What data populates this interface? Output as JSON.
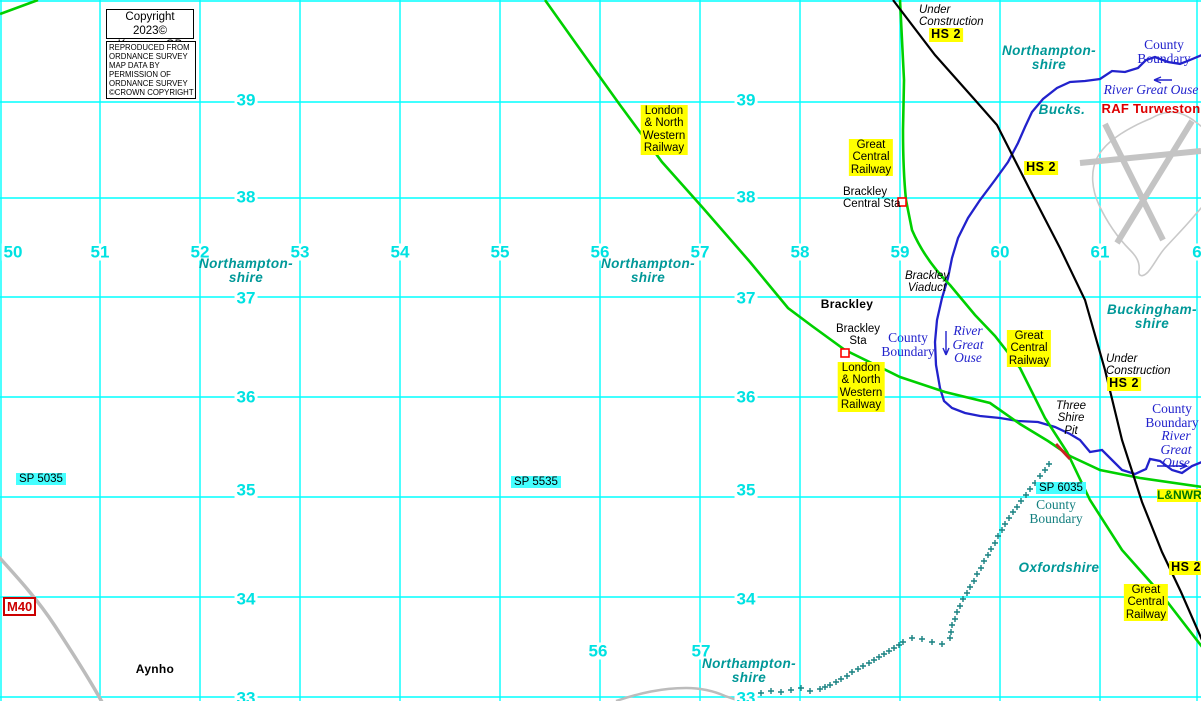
{
  "title": "KeymapsGB map extract - Brackley area",
  "copyright": {
    "line1": "Copyright 2023©",
    "line2": "KeymapsGB",
    "notice": "REPRODUCED FROM\nORDNANCE SURVEY\nMAP DATA BY\nPERMISSION OF\nORDNANCE SURVEY\n©CROWN COPYRIGHT"
  },
  "colors": {
    "grid_cyan": "#00ffff",
    "grid_number_cyan": "#00e2e2",
    "railway_green": "#00d000",
    "hs2_black": "#000000",
    "river_blue": "#2222cc",
    "region_teal": "#009898",
    "boundary_teal": "#137f7f",
    "highlight_yellow": "#ffff00",
    "highlight_cyan": "#45ffff",
    "warning_red": "#dd0000",
    "road_gray": "#c4c4c4"
  },
  "grid": {
    "eastings_y": 252,
    "eastings": [
      {
        "v": "50",
        "x": 13
      },
      {
        "v": "51",
        "x": 100
      },
      {
        "v": "52",
        "x": 200
      },
      {
        "v": "53",
        "x": 300
      },
      {
        "v": "54",
        "x": 400
      },
      {
        "v": "55",
        "x": 500
      },
      {
        "v": "56",
        "x": 600
      },
      {
        "v": "57",
        "x": 700
      },
      {
        "v": "58",
        "x": 800
      },
      {
        "v": "59",
        "x": 900
      },
      {
        "v": "60",
        "x": 1000
      },
      {
        "v": "61",
        "x": 1100
      },
      {
        "v": "6",
        "x": 1197
      }
    ],
    "bottom_eastings_y": 651,
    "bottom_eastings": [
      {
        "v": "56",
        "x": 598
      },
      {
        "v": "57",
        "x": 701
      }
    ],
    "northing_xs": [
      246,
      746
    ],
    "northings": [
      {
        "v": "39",
        "y": 100
      },
      {
        "v": "38",
        "y": 197
      },
      {
        "v": "37",
        "y": 298
      },
      {
        "v": "36",
        "y": 397
      },
      {
        "v": "35",
        "y": 490
      },
      {
        "v": "34",
        "y": 599
      },
      {
        "v": "33",
        "y": 698
      }
    ]
  },
  "labels_static": {
    "m40": "M40"
  },
  "labels": [
    {
      "name": "under-construction-label-top",
      "text": "Under\nConstruction",
      "x": 919,
      "y": 4,
      "cls": "ital left sm"
    },
    {
      "name": "hs2-label-top",
      "text": "HS 2",
      "x": 946,
      "y": 28,
      "cls": "yellow hs2"
    },
    {
      "name": "northamptonshire-label-topright",
      "text": "Northampton-\nshire",
      "x": 1049,
      "y": 44,
      "cls": "tealregion"
    },
    {
      "name": "county-boundary-label-topright",
      "text": "County\nBoundary",
      "x": 1164,
      "y": 38,
      "cls": "blue"
    },
    {
      "name": "river-great-ouse-label-topright",
      "text": "River Great Ouse",
      "x": 1151,
      "y": 83,
      "cls": "blue ital"
    },
    {
      "name": "bucks-label",
      "text": "Bucks.",
      "x": 1062,
      "y": 103,
      "cls": "tealregion"
    },
    {
      "name": "raf-turweston-label",
      "text": "RAF Turweston",
      "x": 1151,
      "y": 102,
      "cls": "red"
    },
    {
      "name": "lnwr-label-top",
      "text": "London\n& North\nWestern\nRailway",
      "x": 664,
      "y": 105,
      "cls": "yellow"
    },
    {
      "name": "gcr-label-top",
      "text": "Great\nCentral\nRailway",
      "x": 871,
      "y": 139,
      "cls": "yellow"
    },
    {
      "name": "brackley-central-sta-label",
      "text": "Brackley\nCentral Sta",
      "x": 843,
      "y": 186,
      "cls": "sm left"
    },
    {
      "name": "hs2-label-2",
      "text": "HS 2",
      "x": 1041,
      "y": 161,
      "cls": "yellow hs2"
    },
    {
      "name": "northamptonshire-label-left",
      "text": "Northampton-\nshire",
      "x": 246,
      "y": 257,
      "cls": "tealregion"
    },
    {
      "name": "northamptonshire-label-mid",
      "text": "Northampton-\nshire",
      "x": 648,
      "y": 257,
      "cls": "tealregion"
    },
    {
      "name": "brackley-viaduct-label",
      "text": "Brackley\nViaduct",
      "x": 927,
      "y": 270,
      "cls": "ital sm"
    },
    {
      "name": "brackley-label",
      "text": "Brackley",
      "x": 847,
      "y": 298,
      "cls": "bold"
    },
    {
      "name": "buckinghamshire-label",
      "text": "Buckingham-\nshire",
      "x": 1152,
      "y": 303,
      "cls": "tealregion"
    },
    {
      "name": "brackley-sta-label",
      "text": "Brackley\nSta",
      "x": 858,
      "y": 323,
      "cls": "sm"
    },
    {
      "name": "county-boundary-label-mid",
      "text": "County\nBoundary",
      "x": 908,
      "y": 331,
      "cls": "blue"
    },
    {
      "name": "river-great-ouse-label-mid",
      "text": "River\nGreat\nOuse",
      "x": 968,
      "y": 324,
      "cls": "blue ital"
    },
    {
      "name": "gcr-label-mid",
      "text": "Great\nCentral\nRailway",
      "x": 1029,
      "y": 330,
      "cls": "yellow"
    },
    {
      "name": "lnwr-label-mid",
      "text": "London\n& North\nWestern\nRailway",
      "x": 861,
      "y": 362,
      "cls": "yellow"
    },
    {
      "name": "under-construction-label-right",
      "text": "Under\nConstruction",
      "x": 1106,
      "y": 353,
      "cls": "ital left sm"
    },
    {
      "name": "hs2-label-3",
      "text": "HS 2",
      "x": 1124,
      "y": 377,
      "cls": "yellow hs2"
    },
    {
      "name": "three-shire-pit-label",
      "text": "Three\nShire\nPit",
      "x": 1071,
      "y": 400,
      "cls": "ital sm"
    },
    {
      "name": "county-boundary-label-right",
      "text": "County\nBoundary",
      "x": 1172,
      "y": 402,
      "cls": "blue"
    },
    {
      "name": "river-great-ouse-label-right",
      "text": "River\nGreat\nOuse",
      "x": 1176,
      "y": 429,
      "cls": "blue ital"
    },
    {
      "name": "sp-5035-label",
      "text": "SP 5035",
      "x": 16,
      "y": 473,
      "cls": "cyanbg left"
    },
    {
      "name": "sp-5535-label",
      "text": "SP 5535",
      "x": 511,
      "y": 476,
      "cls": "cyanbg left"
    },
    {
      "name": "sp-6035-label",
      "text": "SP 6035",
      "x": 1036,
      "y": 482,
      "cls": "cyanbg left"
    },
    {
      "name": "lnwr-label-right",
      "text": "L&NWR",
      "x": 1157,
      "y": 489,
      "cls": "greenyel left"
    },
    {
      "name": "county-boundary-label-oxford",
      "text": "County\nBoundary",
      "x": 1056,
      "y": 498,
      "cls": "tealserif"
    },
    {
      "name": "oxfordshire-label",
      "text": "Oxfordshire",
      "x": 1059,
      "y": 561,
      "cls": "tealregion"
    },
    {
      "name": "hs2-label-4",
      "text": "HS 2",
      "x": 1186,
      "y": 561,
      "cls": "yellow hs2"
    },
    {
      "name": "gcr-label-bottom",
      "text": "Great\nCentral\nRailway",
      "x": 1146,
      "y": 584,
      "cls": "yellow"
    },
    {
      "name": "aynho-label",
      "text": "Aynho",
      "x": 155,
      "y": 663,
      "cls": "bold"
    },
    {
      "name": "northamptonshire-label-bottom",
      "text": "Northampton-\nshire",
      "x": 749,
      "y": 657,
      "cls": "tealregion"
    }
  ]
}
